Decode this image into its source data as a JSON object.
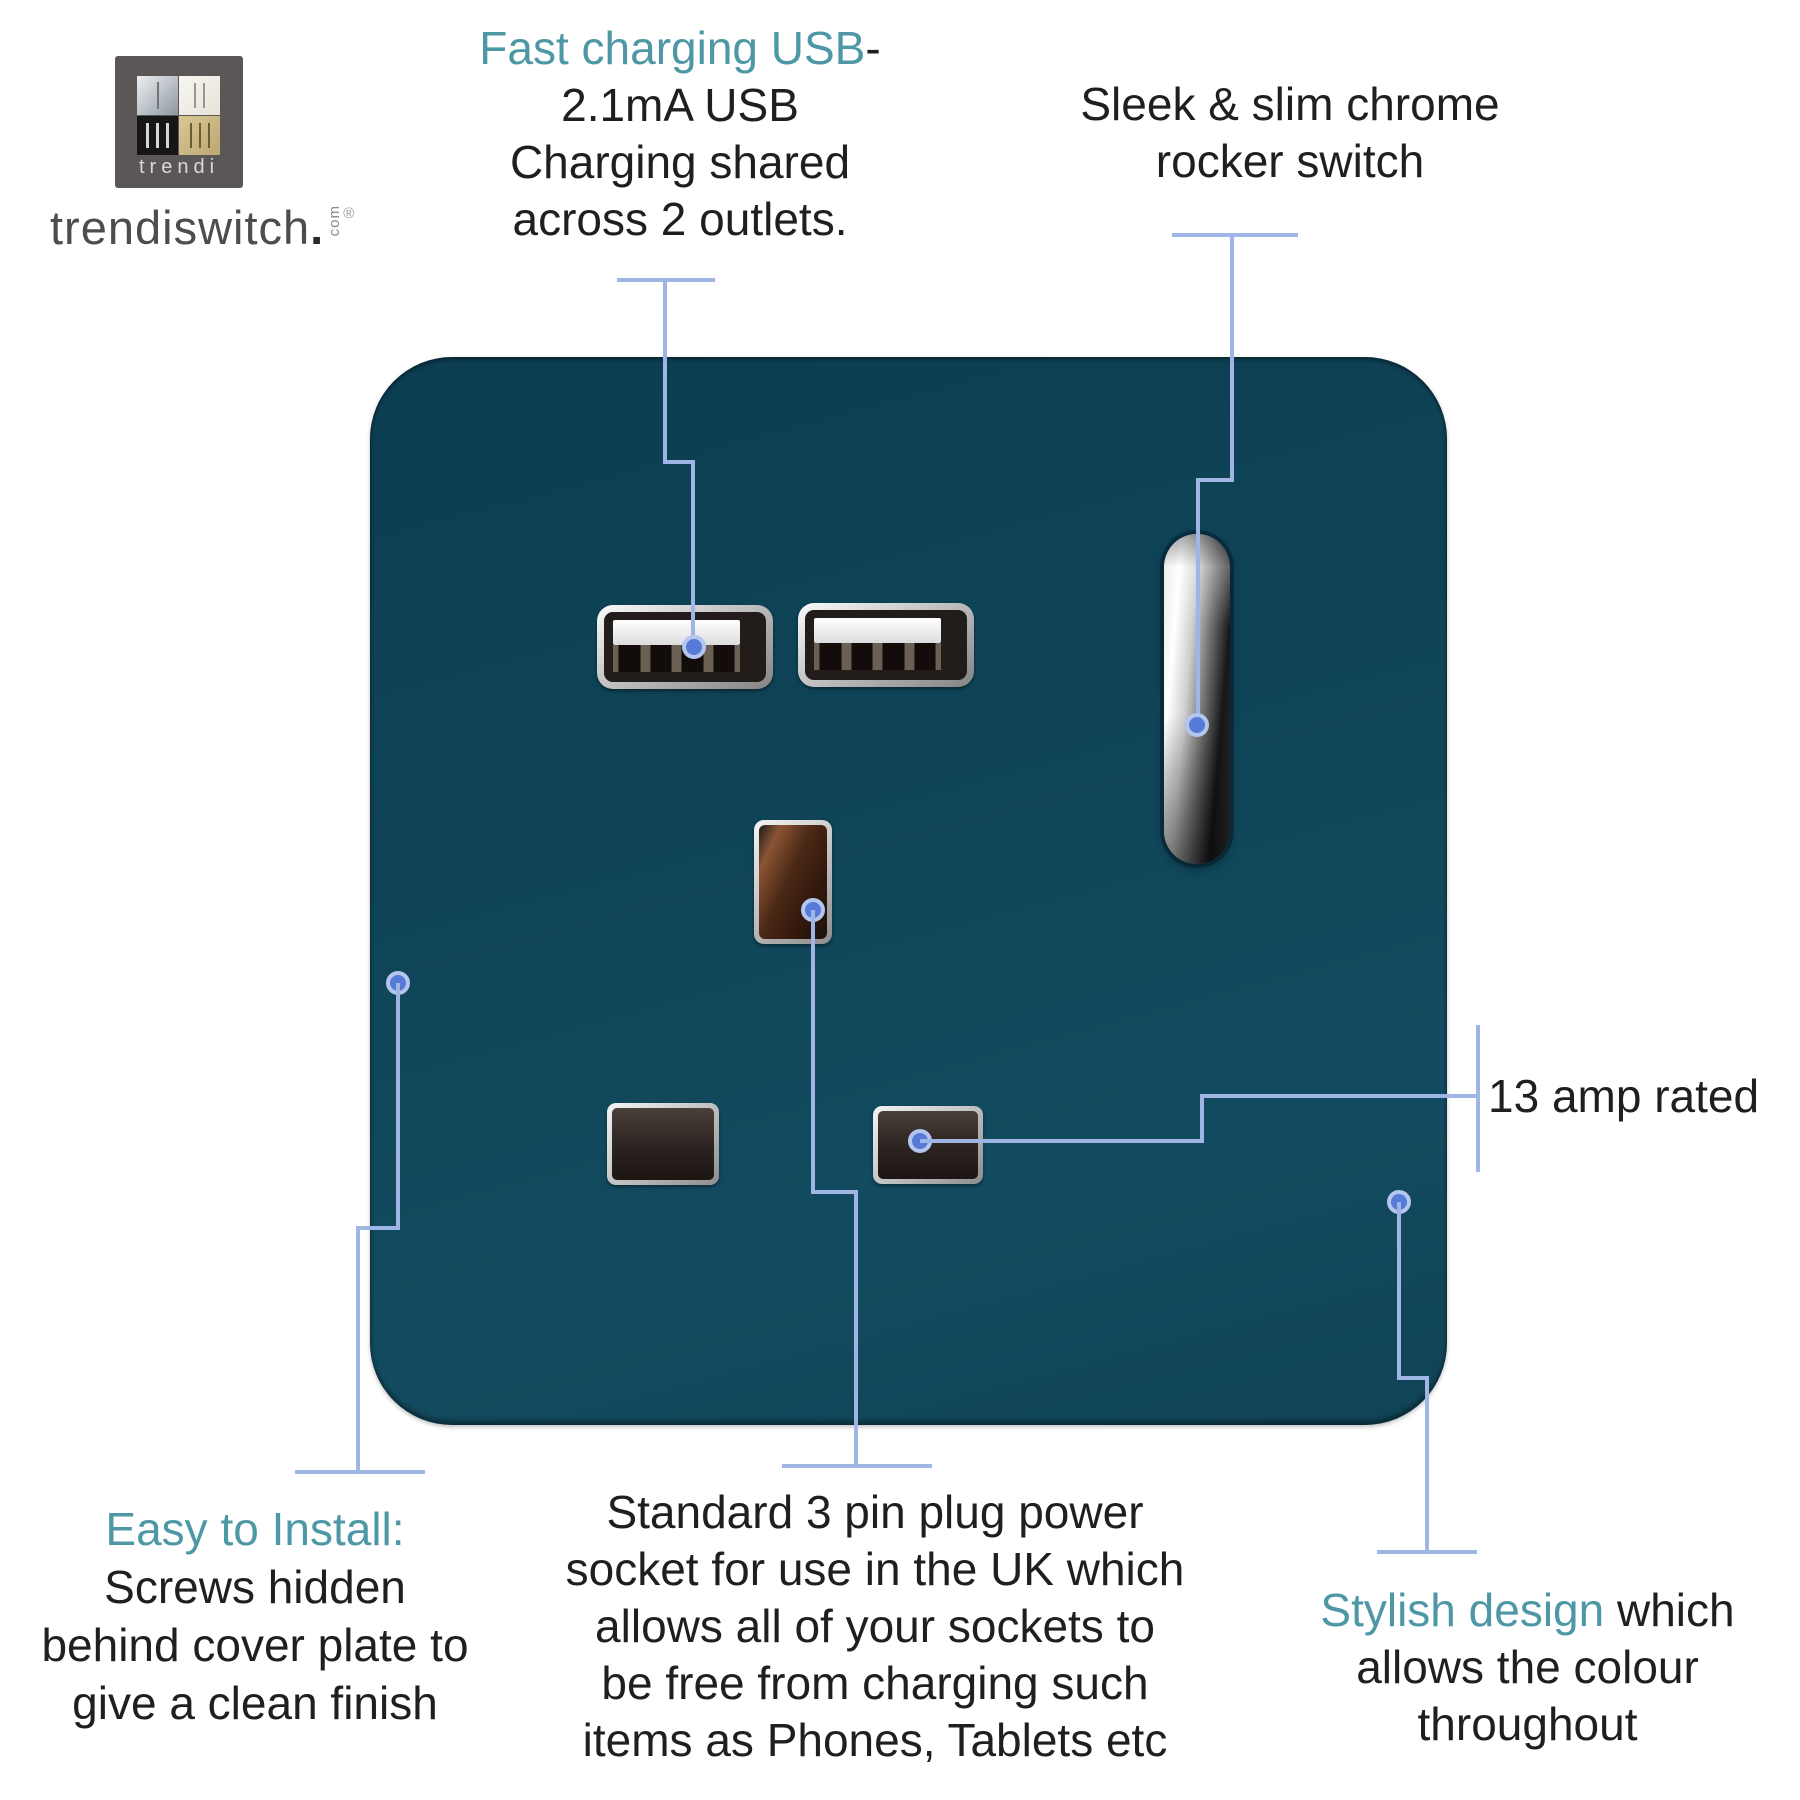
{
  "brand": {
    "logo_label": "trendi",
    "site": "trendiswitch",
    "site_dot": ".",
    "site_tld": "com",
    "registered": "®"
  },
  "callouts": {
    "usb": {
      "heading": "Fast charging USB",
      "heading_suffix": "-",
      "line2": "2.1mA USB",
      "line3": "Charging shared",
      "line4": "across 2 outlets."
    },
    "rocker": {
      "line1": "Sleek & slim chrome",
      "line2": "rocker switch"
    },
    "amp": {
      "label": "13 amp rated"
    },
    "install": {
      "heading": "Easy to Install:",
      "line1": "Screws hidden",
      "line2": "behind cover plate to",
      "line3": "give a clean finish"
    },
    "socket": {
      "line1": "Standard 3 pin plug power",
      "line2": "socket for use in the UK which",
      "line3": "allows all of your sockets to",
      "line4": "be free from charging such",
      "line5": "items as Phones, Tablets etc"
    },
    "stylish": {
      "heading": "Stylish design",
      "heading_suffix": " which",
      "line2": "allows the colour",
      "line3": "throughout"
    }
  },
  "colors": {
    "plate_teal": "#0f4457",
    "accent_teal": "#4e98a6",
    "text_dark": "#1f1f1f",
    "callout_line": "#9fb6e4",
    "callout_dot": "#577ad8"
  }
}
